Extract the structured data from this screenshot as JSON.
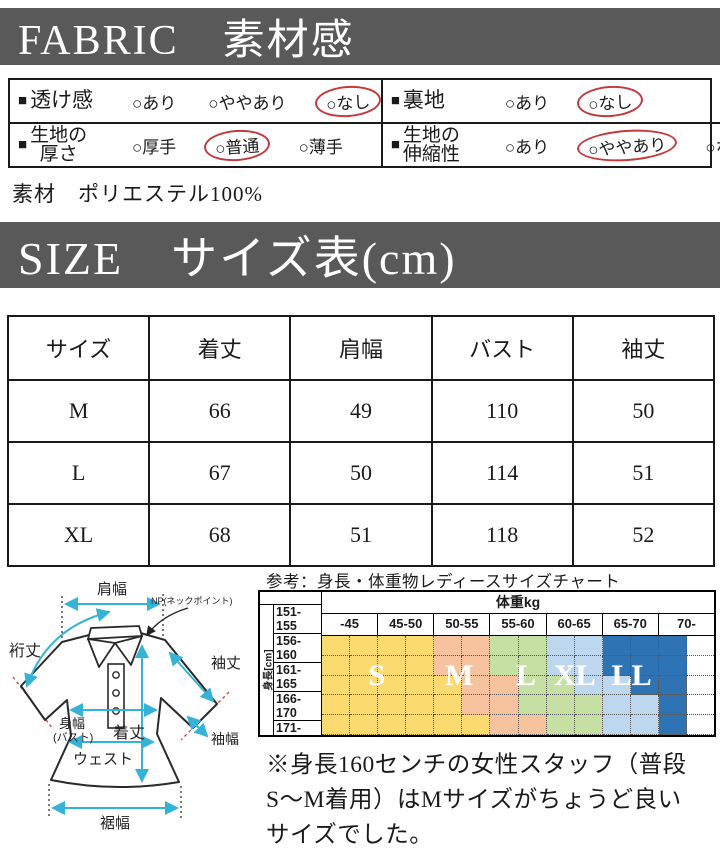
{
  "colors": {
    "banner_bg": "#595959",
    "circle_red": "#c23b3c",
    "arrow_cyan": "#35b3d6",
    "size_S": "#fbdb70",
    "size_M": "#f6c39e",
    "size_L": "#c6e0a4",
    "size_XL": "#bdd7ee",
    "size_LL": "#2e74b5",
    "empty": "#ffffff"
  },
  "fabric": {
    "banner": "FABRIC　素材感",
    "bullet": "■",
    "option_mark": "○",
    "cells": [
      {
        "label_lines": [
          "透け感"
        ],
        "options": [
          {
            "text": "あり",
            "selected": false
          },
          {
            "text": "ややあり",
            "selected": false
          },
          {
            "text": "なし",
            "selected": true
          }
        ]
      },
      {
        "label_lines": [
          "裏地"
        ],
        "options": [
          {
            "text": "あり",
            "selected": false
          },
          {
            "text": "なし",
            "selected": true
          }
        ]
      },
      {
        "label_lines": [
          "生地の",
          "厚さ"
        ],
        "options": [
          {
            "text": "厚手",
            "selected": false
          },
          {
            "text": "普通",
            "selected": true
          },
          {
            "text": "薄手",
            "selected": false
          }
        ]
      },
      {
        "label_lines": [
          "生地の",
          "伸縮性"
        ],
        "options": [
          {
            "text": "あり",
            "selected": false
          },
          {
            "text": "ややあり",
            "selected": true
          },
          {
            "text": "なし",
            "selected": false
          }
        ]
      }
    ]
  },
  "material_line": "素材　ポリエステル100%",
  "size_section": {
    "banner": "SIZE　サイズ表(cm)",
    "table": {
      "headers": [
        "サイズ",
        "着丈",
        "肩幅",
        "バスト",
        "袖丈"
      ],
      "rows": [
        [
          "M",
          "66",
          "49",
          "110",
          "50"
        ],
        [
          "L",
          "67",
          "50",
          "114",
          "51"
        ],
        [
          "XL",
          "68",
          "51",
          "118",
          "52"
        ]
      ]
    }
  },
  "diagram": {
    "labels": {
      "shoulder": "肩幅",
      "yuki": "裄丈",
      "np": "NP(ネックポイント)",
      "sleeve_len": "袖丈",
      "sleeve_w": "袖幅",
      "body_w1": "身幅",
      "body_w2": "(バスト)",
      "length": "着丈",
      "waist": "ウェスト",
      "hem": "裾幅"
    }
  },
  "ref_chart": {
    "caption": "参考：身長・体重物レディースサイズチャート",
    "weight_header": "体重kg",
    "weight_cols": [
      "-45",
      "45-50",
      "50-55",
      "55-60",
      "60-65",
      "65-70",
      "70-"
    ],
    "height_label": "身長[cm]",
    "rows": [
      {
        "label": "151-155",
        "cells": [
          "S",
          "S",
          "S",
          "S",
          "M",
          "M",
          "L",
          "L",
          "XL",
          "XL",
          "LL",
          "LL",
          "LL",
          "-"
        ]
      },
      {
        "label": "156-160",
        "cells": [
          "S",
          "S",
          "S",
          "S",
          "M",
          "M",
          "L",
          "L",
          "XL",
          "XL",
          "LL",
          "LL",
          "LL",
          "-"
        ]
      },
      {
        "label": "161-165",
        "cells": [
          "S",
          "S",
          "S",
          "S",
          "S",
          "M",
          "M",
          "L",
          "L",
          "XL",
          "XL",
          "LL",
          "LL",
          "-"
        ]
      },
      {
        "label": "166-170",
        "cells": [
          "S",
          "S",
          "S",
          "S",
          "S",
          "M",
          "M",
          "L",
          "L",
          "L",
          "XL",
          "XL",
          "LL",
          "-"
        ]
      },
      {
        "label": "171-",
        "cells": [
          "S",
          "S",
          "S",
          "S",
          "S",
          "S",
          "M",
          "M",
          "L",
          "L",
          "XL",
          "XL",
          "LL",
          "-"
        ]
      }
    ],
    "letters": [
      {
        "text": "S",
        "left": 14
      },
      {
        "text": "M",
        "left": 35
      },
      {
        "text": "L",
        "left": 52
      },
      {
        "text": "XL",
        "left": 64.5
      },
      {
        "text": "LL",
        "left": 79
      }
    ]
  },
  "note_lines": [
    "※身長160センチの女性スタッフ（普段",
    "S〜M着用）はMサイズがちょうど良い",
    "サイズでした。"
  ]
}
